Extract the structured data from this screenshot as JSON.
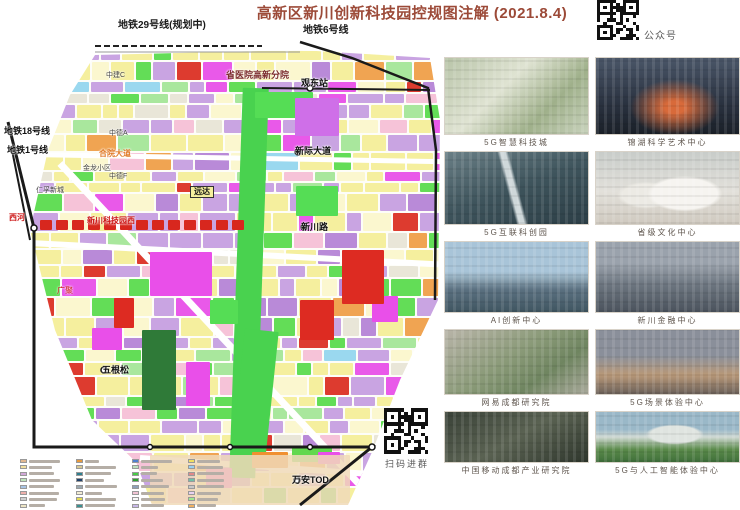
{
  "title": "高新区新川创新科技园控规图注解 (2021.8.4)",
  "qr_top": {
    "label": "公众号"
  },
  "qr_bottom": {
    "label": "扫码进群"
  },
  "colors": {
    "title": "#9c4a38",
    "map_yellow": "#f5ef9e",
    "map_purple": "#c9a4e2",
    "map_magenta": "#e959e9",
    "map_green": "#63dd57",
    "map_red": "#d8271e",
    "map_orange": "#f0a452"
  },
  "map": {
    "labels": [
      {
        "text": "地铁29号线(规划中)",
        "x": 118,
        "y": 21,
        "size": 10,
        "color": "#1a1a1a",
        "bold": true
      },
      {
        "text": "地铁6号线",
        "x": 303,
        "y": 26,
        "size": 10,
        "color": "#1a1a1a",
        "bold": true
      },
      {
        "text": "中建C",
        "x": 106,
        "y": 72,
        "size": 7,
        "color": "#444444"
      },
      {
        "text": "省医院高新分院",
        "x": 226,
        "y": 71,
        "size": 9,
        "color": "#7a2a2a",
        "bold": true
      },
      {
        "text": "观东站",
        "x": 301,
        "y": 79,
        "size": 9,
        "color": "#111111",
        "bold": true
      },
      {
        "text": "地铁18号线",
        "x": 4,
        "y": 127,
        "size": 9,
        "color": "#111111",
        "bold": true
      },
      {
        "text": "地铁1号线",
        "x": 7,
        "y": 146,
        "size": 9,
        "color": "#111111",
        "bold": true
      },
      {
        "text": "中德A",
        "x": 109,
        "y": 130,
        "size": 7,
        "color": "#444444"
      },
      {
        "text": "合院大道",
        "x": 99,
        "y": 150,
        "size": 8,
        "color": "#e07a28",
        "bold": true
      },
      {
        "text": "金龙小区",
        "x": 83,
        "y": 165,
        "size": 7,
        "color": "#444444"
      },
      {
        "text": "中德F",
        "x": 109,
        "y": 173,
        "size": 7,
        "color": "#444444"
      },
      {
        "text": "新际大道",
        "x": 295,
        "y": 147,
        "size": 9,
        "color": "#111111",
        "bold": true
      },
      {
        "text": "仁孚新城",
        "x": 36,
        "y": 187,
        "size": 7,
        "color": "#444444"
      },
      {
        "text": "远达",
        "x": 190,
        "y": 186,
        "size": 8,
        "color": "#111111",
        "bold": true,
        "boxed": true
      },
      {
        "text": "西河",
        "x": 9,
        "y": 214,
        "size": 8,
        "color": "#cc1515",
        "bold": true
      },
      {
        "text": "新川科技园西",
        "x": 87,
        "y": 217,
        "size": 8,
        "color": "#cc1515",
        "bold": true
      },
      {
        "text": "广聚",
        "x": 57,
        "y": 287,
        "size": 8,
        "color": "#cc1515"
      },
      {
        "text": "新川路",
        "x": 301,
        "y": 223,
        "size": 9,
        "color": "#111111",
        "bold": true
      },
      {
        "text": "五根松",
        "x": 102,
        "y": 366,
        "size": 9,
        "color": "#111111",
        "bold": true
      },
      {
        "text": "万安TOD",
        "x": 292,
        "y": 476,
        "size": 9,
        "color": "#111111",
        "bold": true
      }
    ]
  },
  "gallery": {
    "items": [
      {
        "caption": "5G智慧科技城"
      },
      {
        "caption": "锦湖科学艺术中心"
      },
      {
        "caption": "5G互联科创园"
      },
      {
        "caption": "省级文化中心"
      },
      {
        "caption": "AI创新中心"
      },
      {
        "caption": "新川金融中心"
      },
      {
        "caption": "网易成都研究院"
      },
      {
        "caption": "5G场景体验中心"
      },
      {
        "caption": "中国移动成都产业研究院"
      },
      {
        "caption": "5G与人工智能体验中心"
      }
    ]
  }
}
